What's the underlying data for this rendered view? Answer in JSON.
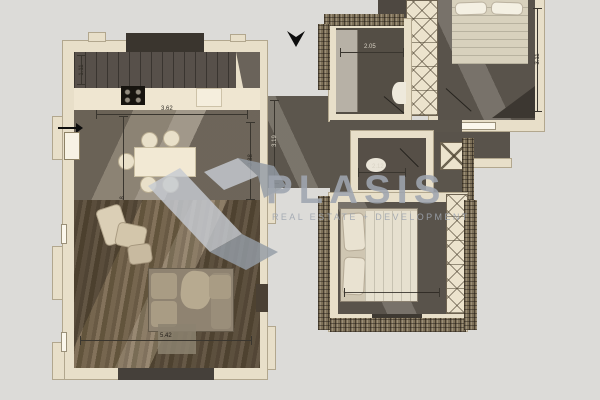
{
  "watermark": {
    "brand": "PLASIS",
    "tagline": "REAL ESTATE + DEVELOPMENT",
    "color": "#9aa1ab",
    "logo": "angular-ribbon-mark"
  },
  "marker": {
    "icon": "down-arrow"
  },
  "ground_floor": {
    "dims": {
      "stairs": "1.11",
      "top": "3.62",
      "left": "2.48",
      "right": "2.88",
      "bottom": "5.42"
    }
  },
  "upper_floor": {
    "dims": {
      "bathroom": "2.05",
      "wc": "2.12",
      "bedroom_side": "3.11",
      "hall": "3.19"
    }
  },
  "colors": {
    "background": "#dcdbd8",
    "wall": "#e8dfc9",
    "floor_dark": "#59534b",
    "wood": "#7a6950"
  }
}
